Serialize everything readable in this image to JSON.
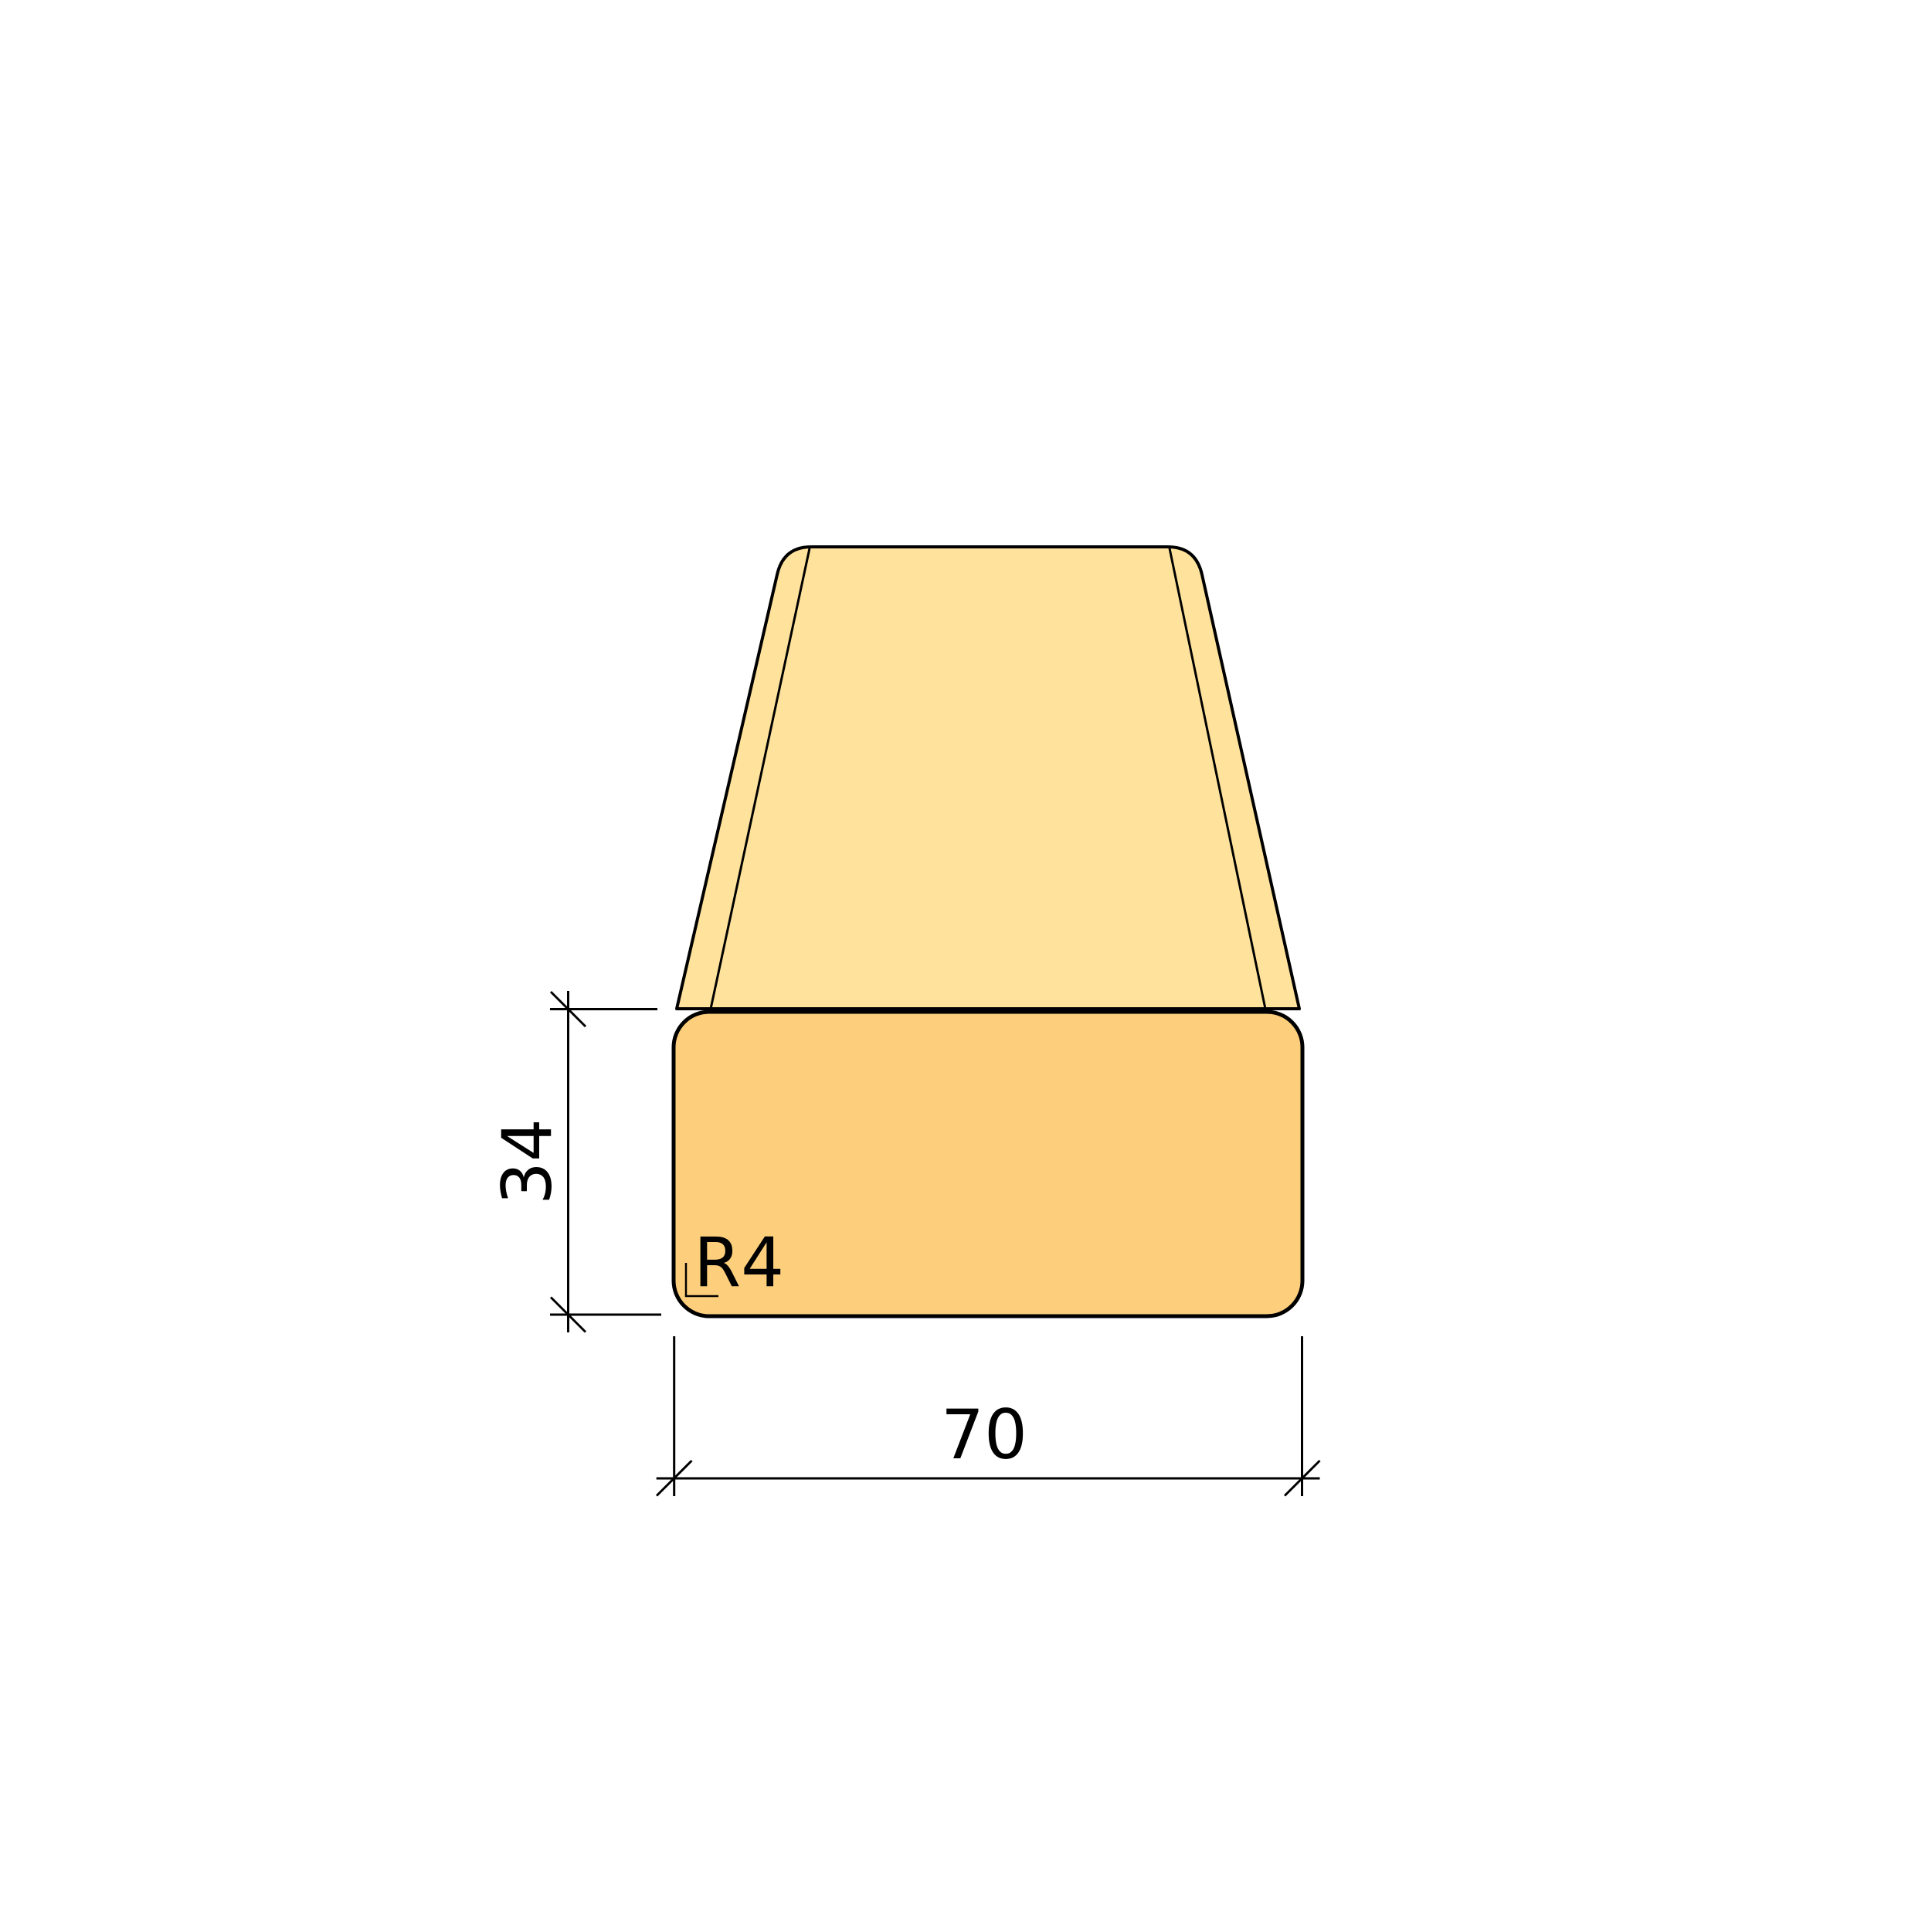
{
  "drawing": {
    "labels": {
      "height_dimension": "34",
      "width_dimension": "70",
      "corner_radius": "R4"
    },
    "colors": {
      "front_face_fill": "#FDCF7C",
      "top_face_fill": "#FFE39C",
      "outline": "#000000",
      "background": "#FFFFFF"
    }
  }
}
